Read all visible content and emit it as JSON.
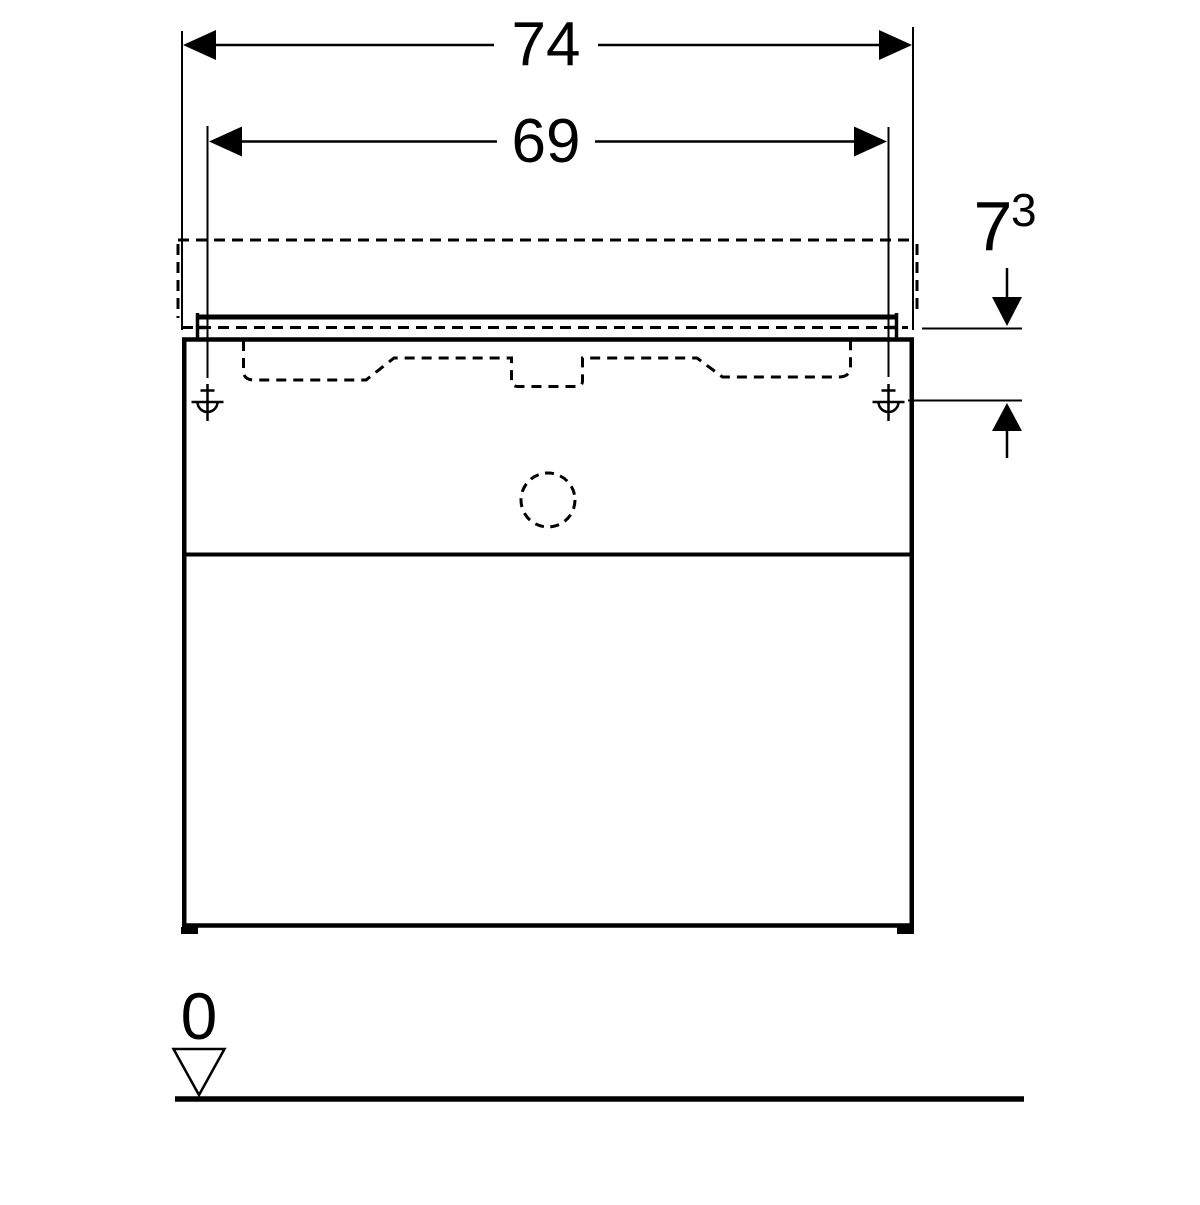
{
  "dims": {
    "overall_width": "74",
    "fixing_width": "69",
    "basin_to_fixing_main": "7",
    "basin_to_fixing_sup": "3",
    "ground_level": "0"
  },
  "colors": {
    "line": "#000000",
    "background": "#ffffff"
  }
}
